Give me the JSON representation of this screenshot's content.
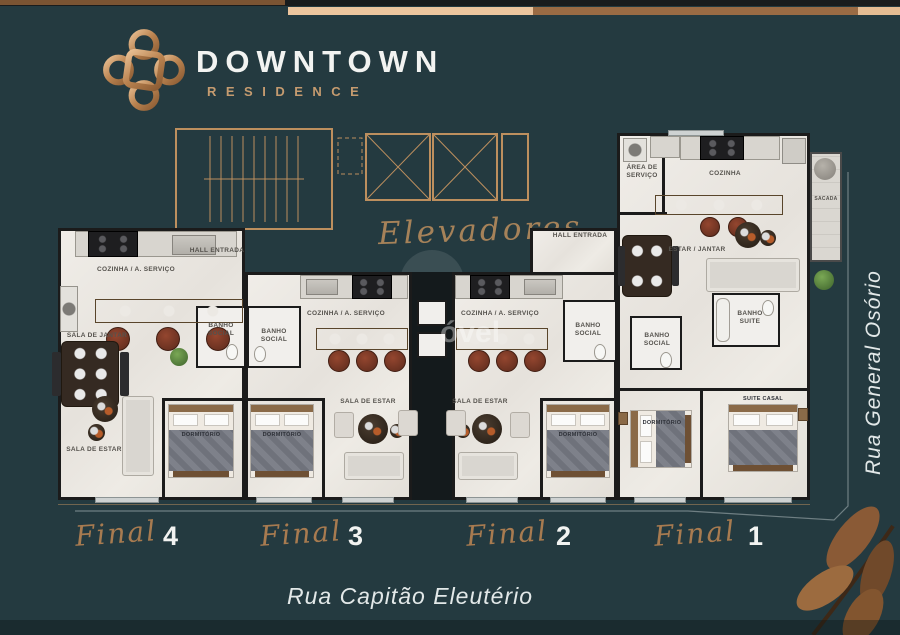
{
  "brand": {
    "name": "DOWNTOWN",
    "subtitle": "RESIDENCE"
  },
  "streets": {
    "right": "Rua General Osório",
    "bottom": "Rua Capitão Eleutério"
  },
  "common": {
    "elevators": "Elevadores"
  },
  "watermark": {
    "text": "óvel"
  },
  "finals": [
    {
      "word": "Final",
      "num": "4"
    },
    {
      "word": "Final",
      "num": "3"
    },
    {
      "word": "Final",
      "num": "2"
    },
    {
      "word": "Final",
      "num": "1"
    }
  ],
  "rooms": {
    "u4_hall": "HALL ENTRADA",
    "u4_cozinha": "COZINHA / A. SERVIÇO",
    "u4_jantar": "SALA DE JANTAR",
    "u4_banho": "BANHO SOCIAL",
    "u4_estar": "SALA DE ESTAR",
    "u4_dorm": "DORMITÓRIO",
    "u3_cozinha": "COZINHA / A. SERVIÇO",
    "u3_banho": "BANHO SOCIAL",
    "u3_estar": "SALA DE ESTAR",
    "u3_dorm": "DORMITÓRIO",
    "u2_cozinha": "COZINHA / A. SERVIÇO",
    "u2_banho": "BANHO SOCIAL",
    "u2_estar": "SALA DE ESTAR",
    "u2_dorm": "DORMITÓRIO",
    "hall_right": "HALL ENTRADA",
    "u1_area": "ÁREA DE SERVIÇO",
    "u1_cozinha": "COZINHA",
    "u1_sacada": "SACADA",
    "u1_estar": "ESTAR / JANTAR",
    "u1_banho_social": "BANHO SOCIAL",
    "u1_banho_suite": "BANHO SUITE",
    "u1_dorm": "DORMITÓRIO",
    "u1_suite": "SUITE CASAL"
  },
  "colors": {
    "background": "#243A40",
    "accent": "#BD8F5E",
    "copper": "#C59B6F",
    "ink": "#F2F3F1",
    "wall": "#1B1B1B",
    "floor": "#EAE7E1"
  }
}
